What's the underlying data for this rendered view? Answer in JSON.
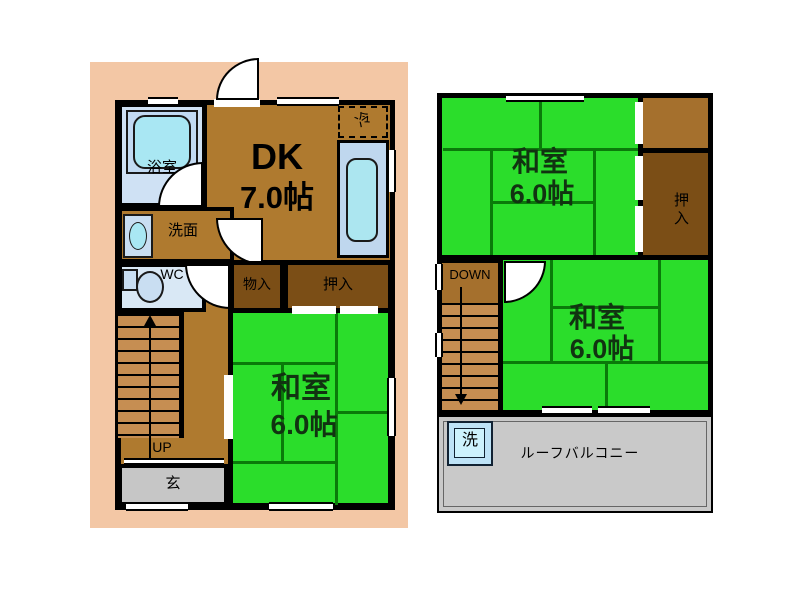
{
  "floorplan": {
    "floor1": {
      "bath": "浴室",
      "dk_name": "DK",
      "dk_size": "7.0帖",
      "fridge": "冷",
      "washroom": "洗面",
      "wc": "WC",
      "storage": "物入",
      "closet": "押入",
      "washitsu_name": "和室",
      "washitsu_size": "6.0帖",
      "stairs_up": "UP",
      "entrance": "玄"
    },
    "floor2": {
      "washitsu_top_name": "和室",
      "washitsu_top_size": "6.0帖",
      "closet": "押入",
      "stairs_down": "DOWN",
      "washitsu_bottom_name": "和室",
      "washitsu_bottom_size": "6.0帖",
      "washer": "洗",
      "balcony": "ルーフバルコニー"
    },
    "colors": {
      "lot_peach": "#F3C7A5",
      "floor_brown": "#AF7A2F",
      "closet_brown": "#7B4E16",
      "stair_tan": "#C68E52",
      "tatami_green": "#2BDD2B",
      "tatami_line_green": "#0A7A0A",
      "water_room_blue": "#CFE1F4",
      "fixture_cyan": "#A9E7F3",
      "counter_blue": "#BFD7EE",
      "entrance_gray": "#C6C6C6",
      "balcony_gray": "#C9C9C9",
      "wall_black": "#000000"
    }
  }
}
